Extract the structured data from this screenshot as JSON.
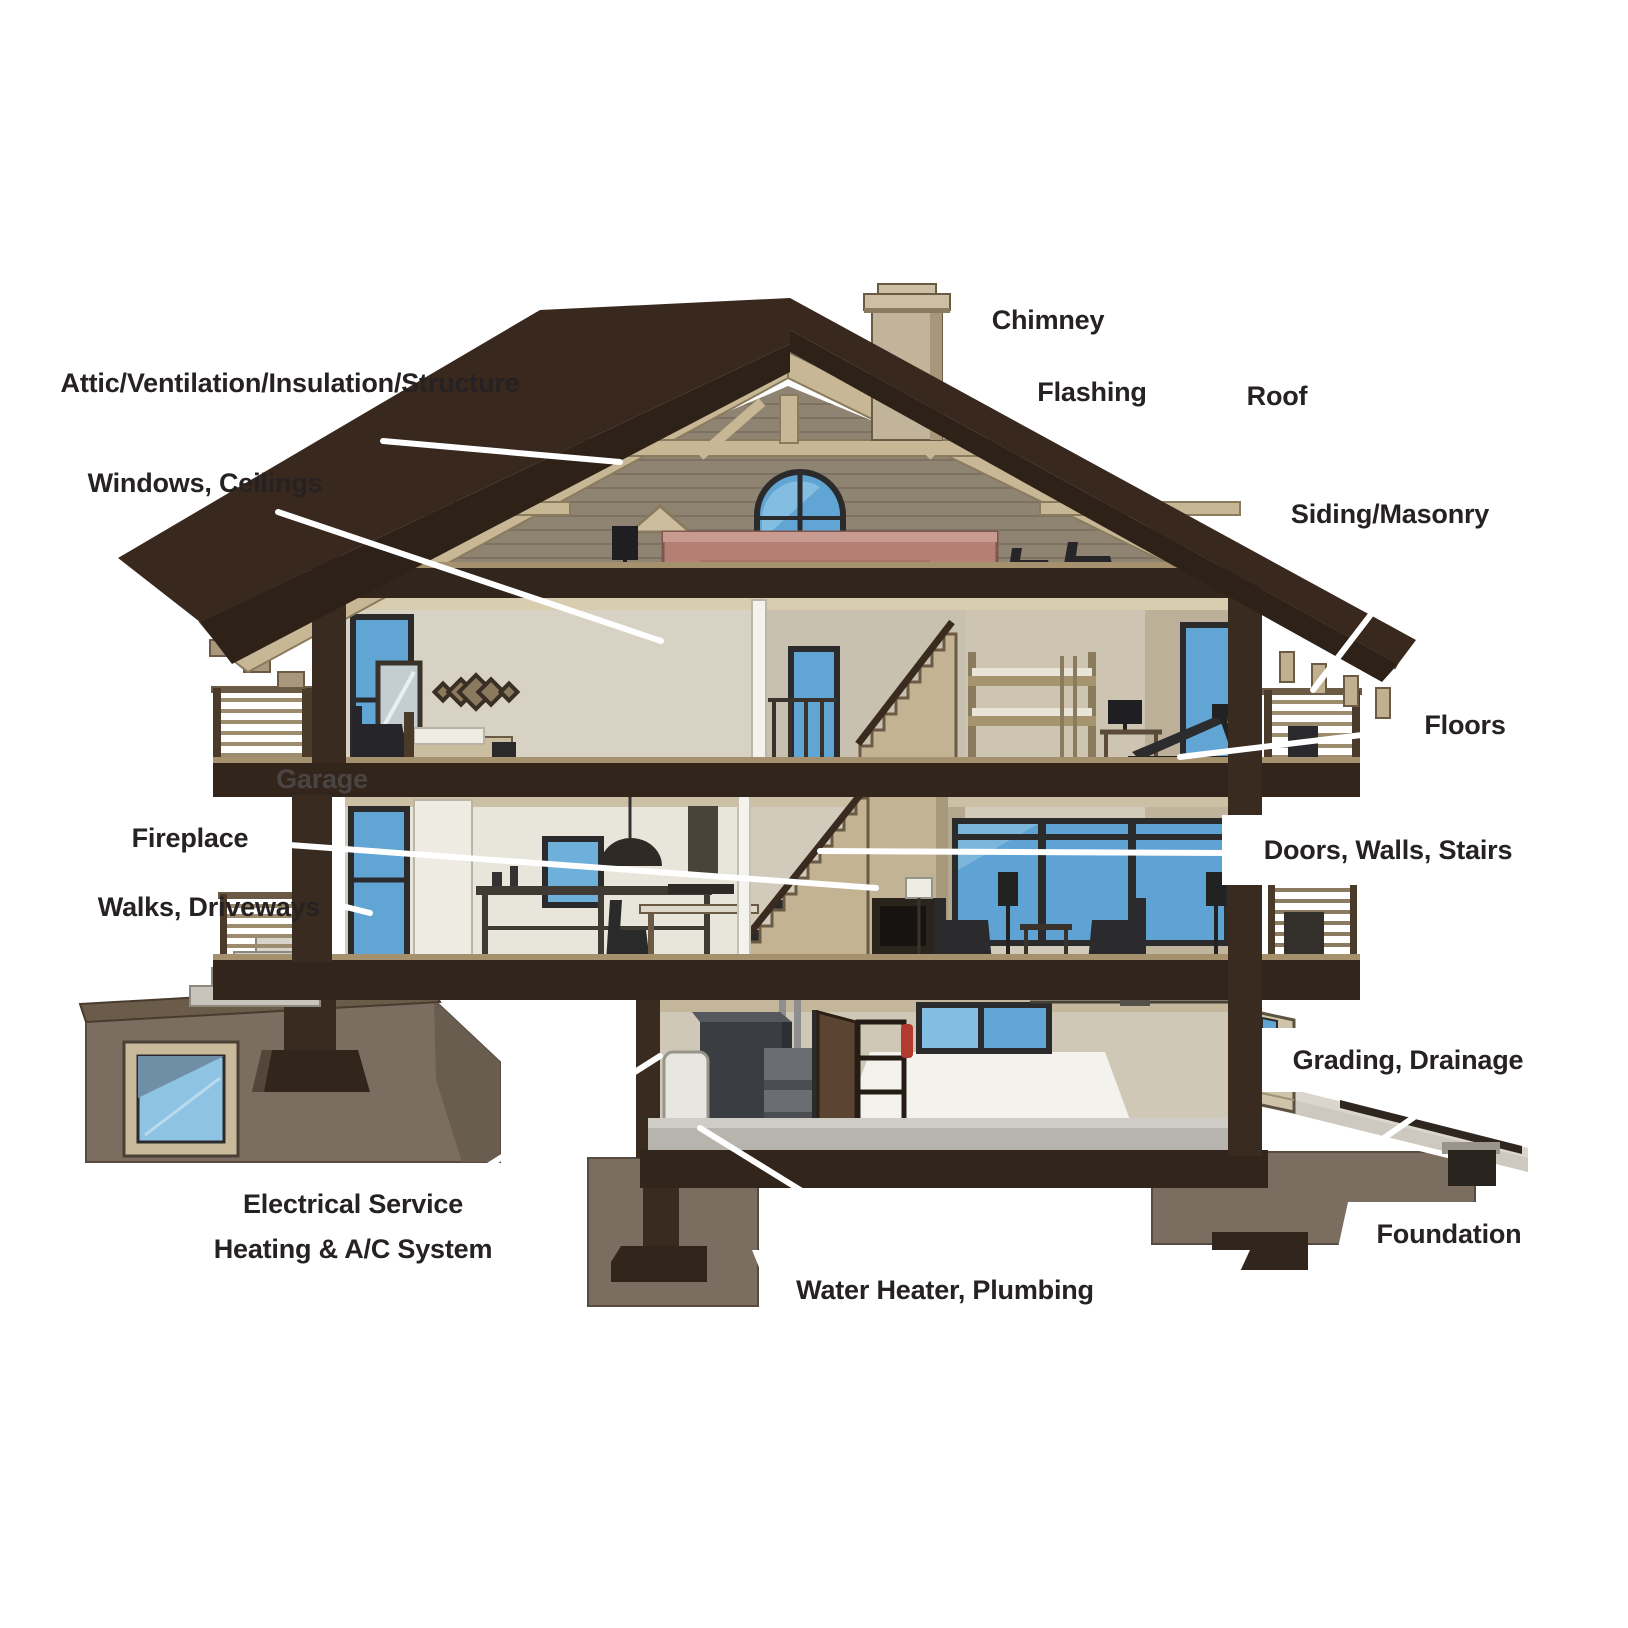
{
  "diagram": {
    "type": "house-cross-section-inspection-diagram",
    "labels": {
      "chimney": "Chimney",
      "attic": "Attic/Ventilation/Insulation/Structure",
      "flashing": "Flashing",
      "roof": "Roof",
      "windows_ceilings": "Windows, Ceilings",
      "siding_masonry": "Siding/Masonry",
      "floors": "Floors",
      "garage": "Garage",
      "fireplace": "Fireplace",
      "walks_driveways": "Walks, Driveways",
      "doors_walls_stairs": "Doors, Walls, Stairs",
      "grading_drainage": "Grading, Drainage",
      "electrical_line1": "Electrical Service",
      "electrical_line2": "Heating & A/C System",
      "water_heater_plumbing": "Water Heater, Plumbing",
      "foundation": "Foundation"
    },
    "colors": {
      "label_text": "#262122",
      "leader_line": "#ffffff",
      "roof_dark": "#38281d",
      "roof_fascia": "#2e2118",
      "wood_tan": "#c8b795",
      "gable_siding": "#8f8471",
      "interior_wall": "#d2cbbc",
      "window_glass": "#61a5d5",
      "floor_band": "#32251c",
      "foundation_taupe": "#7b6e61",
      "concrete": "#d8d4cb",
      "accent_rose": "#b57f76"
    }
  }
}
